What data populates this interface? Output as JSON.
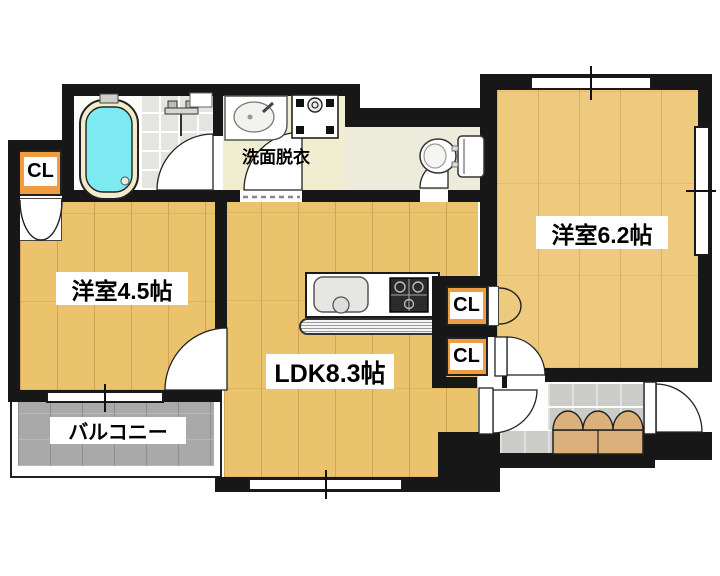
{
  "plan_title": "2LDK apartment floor plan",
  "rooms": {
    "west45": {
      "label": "洋室4.5帖"
    },
    "west62": {
      "label": "洋室6.2帖"
    },
    "ldk": {
      "label": "LDK8.3帖"
    },
    "washroom": {
      "label": "洗面脱衣"
    },
    "balcony": {
      "label": "バルコニー"
    }
  },
  "closets": [
    {
      "label": "CL"
    },
    {
      "label": "CL"
    },
    {
      "label": "CL"
    }
  ],
  "fixtures": [
    "bathtub",
    "shower-mixer",
    "bathroom-shelf",
    "washbasin",
    "washing-machine-pan",
    "toilet",
    "kitchen-sink",
    "gas-stove",
    "shoe-cabinet",
    "entrance-door",
    "balcony-window"
  ],
  "colors": {
    "wall": "#171717",
    "wood_left": "#ebc36d",
    "wood_right": "#edca7e",
    "closet_orange": "#f09c41",
    "bathtub_cyan": "#7de9f0",
    "bathtub_rim": "#f3eccb",
    "washroom_floor": "#f0edd0",
    "corridor_floor": "#edebdc",
    "bath_tile": "#e4e4e1",
    "entrance_tile": "#dadad7",
    "balcony_gray": "#a9a9a9",
    "cabinet_tan": "#dcb07a"
  }
}
